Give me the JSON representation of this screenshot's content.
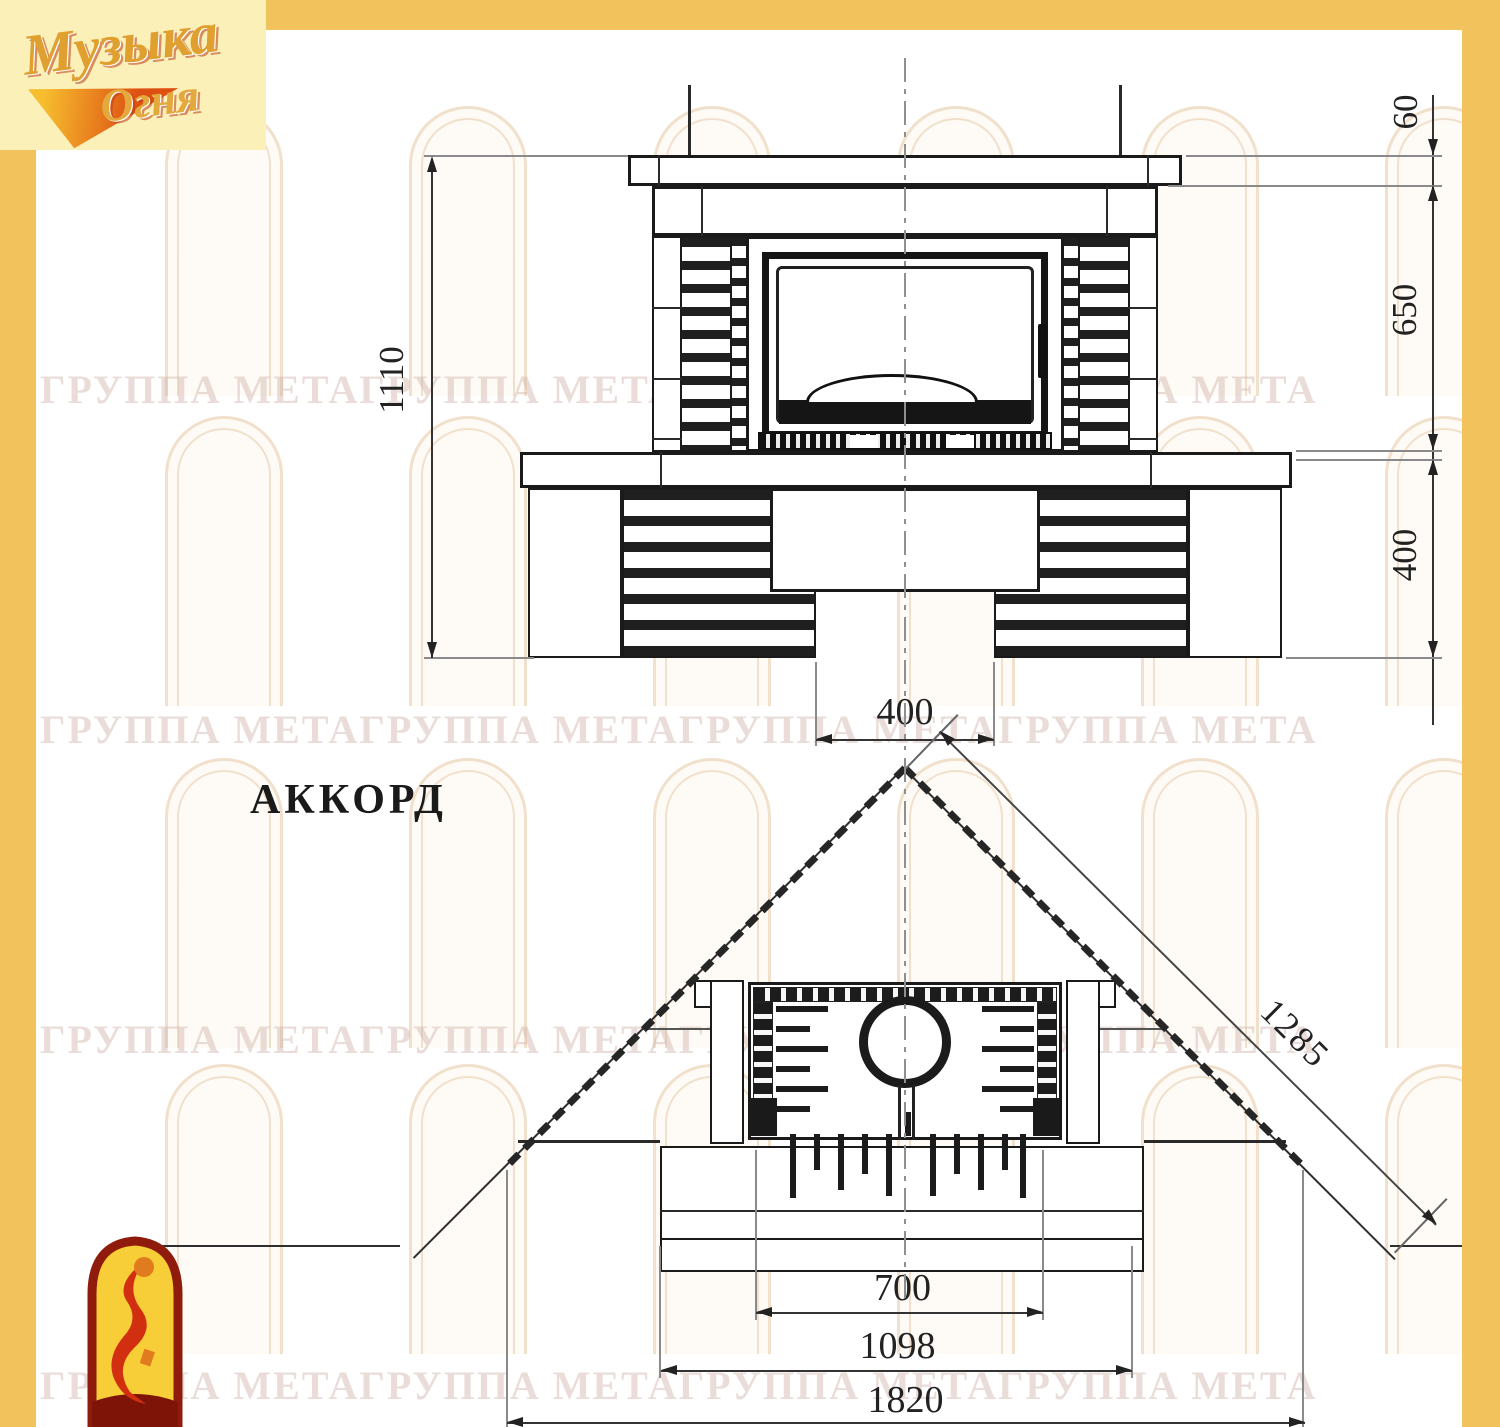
{
  "title": "АККОРД",
  "brand": {
    "word1": "Музыка",
    "word2": "Огня"
  },
  "watermark": {
    "text": "ГРУППА МЕТАГРУППА МЕТАГРУППА МЕТАГРУППА МЕТА"
  },
  "front_view": {
    "dims": {
      "total_height": "1110",
      "mantel_thickness": "60",
      "firebox_zone_height": "650",
      "base_height": "400",
      "foot_gap_width": "400"
    }
  },
  "plan_view": {
    "dims": {
      "side_to_corner": "1285",
      "opening_width": "700",
      "front_width": "1098",
      "overall_width": "1820"
    }
  },
  "colors": {
    "frame_yellow": "#F2C35C",
    "logo_panel": "#FBF0B8",
    "drawing_line": "#262626",
    "watermark": "#CDAFA5"
  }
}
